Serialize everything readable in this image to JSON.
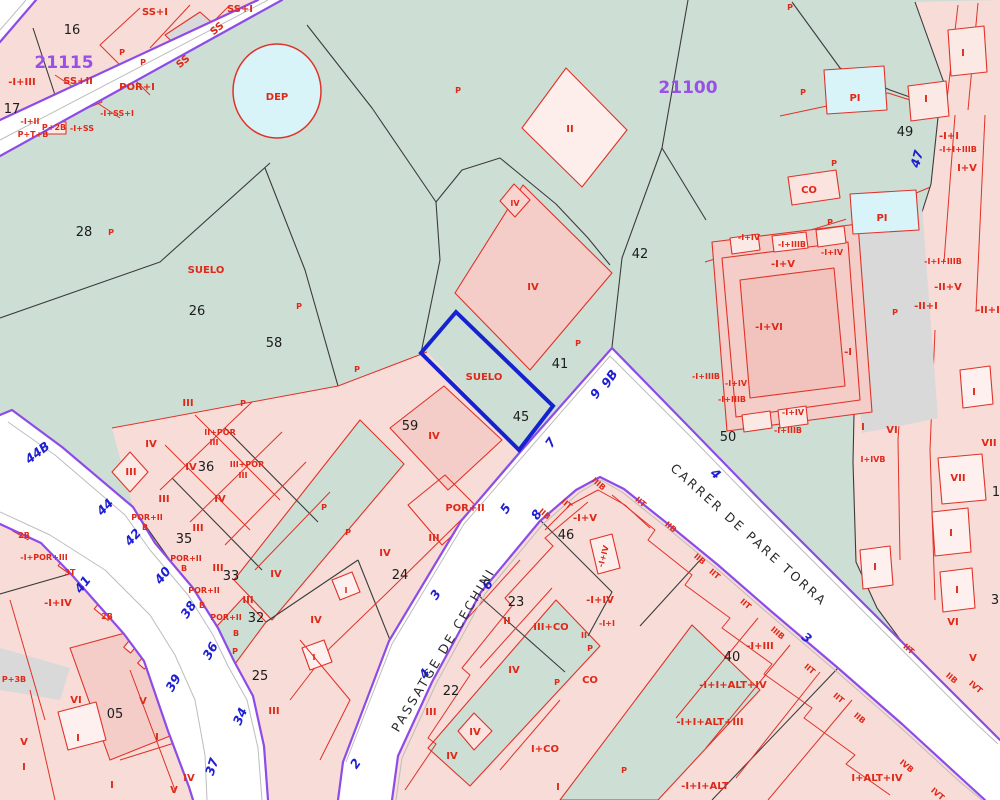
{
  "map": {
    "zone_ids": [
      "21115",
      "21100"
    ],
    "street_names": [
      "PASSATGE DE CECHINI",
      "CARRER DE PARE TORRA"
    ],
    "highlighted_parcel": {
      "number": "45",
      "land_label": "SUELO"
    },
    "colors": {
      "land_green": "#cddfd5",
      "parcel_pink": "#f8dcd7",
      "building_pink": "#f5cdc8",
      "road_white": "#ffffff",
      "boundary_purple": "#8d4be8",
      "highlight_blue": "#1523cf",
      "cadastre_red": "#e02818",
      "zone_purple": "#9950e8",
      "water_cyan": "#d8f4f8"
    }
  },
  "labels": [
    {
      "t": "16",
      "x": 72,
      "y": 34,
      "c": "k"
    },
    {
      "t": "21115",
      "x": 64,
      "y": 68,
      "c": "v",
      "n": "zone-id-21115"
    },
    {
      "t": "-I+III",
      "x": 22,
      "y": 85,
      "c": "r"
    },
    {
      "t": "SS+II",
      "x": 78,
      "y": 84,
      "c": "r"
    },
    {
      "t": "17",
      "x": 12,
      "y": 113,
      "c": "k"
    },
    {
      "t": "POR+I",
      "x": 137,
      "y": 90,
      "c": "r"
    },
    {
      "t": "-I+SS+I",
      "x": 117,
      "y": 116,
      "c": "s"
    },
    {
      "t": "-I+II",
      "x": 30,
      "y": 124,
      "c": "s"
    },
    {
      "t": "P+2B",
      "x": 54,
      "y": 130,
      "c": "s"
    },
    {
      "t": "P+T+B",
      "x": 33,
      "y": 137,
      "c": "s"
    },
    {
      "t": "-I+SS",
      "x": 82,
      "y": 131,
      "c": "s"
    },
    {
      "t": "SS+I",
      "x": 155,
      "y": 15,
      "c": "r"
    },
    {
      "t": "SS+I",
      "x": 240,
      "y": 12,
      "c": "r"
    },
    {
      "t": "SS",
      "x": 219,
      "y": 31,
      "c": "r",
      "r": -40
    },
    {
      "t": "SS",
      "x": 185,
      "y": 64,
      "c": "r",
      "r": -40
    },
    {
      "t": "P",
      "x": 122,
      "y": 55,
      "c": "s"
    },
    {
      "t": "P",
      "x": 143,
      "y": 65,
      "c": "s"
    },
    {
      "t": "DEP",
      "x": 277,
      "y": 100,
      "c": "r",
      "n": "deposit-label"
    },
    {
      "t": "P",
      "x": 458,
      "y": 93,
      "c": "s"
    },
    {
      "t": "28",
      "x": 84,
      "y": 236,
      "c": "k"
    },
    {
      "t": "P",
      "x": 111,
      "y": 235,
      "c": "s"
    },
    {
      "t": "SUELO",
      "x": 206,
      "y": 273,
      "c": "r"
    },
    {
      "t": "26",
      "x": 197,
      "y": 315,
      "c": "k"
    },
    {
      "t": "58",
      "x": 274,
      "y": 347,
      "c": "k"
    },
    {
      "t": "P",
      "x": 299,
      "y": 309,
      "c": "s"
    },
    {
      "t": "P",
      "x": 357,
      "y": 372,
      "c": "s"
    },
    {
      "t": "II",
      "x": 570,
      "y": 132,
      "c": "r"
    },
    {
      "t": "21100",
      "x": 688,
      "y": 93,
      "c": "v",
      "n": "zone-id-21100"
    },
    {
      "t": "42",
      "x": 640,
      "y": 258,
      "c": "k"
    },
    {
      "t": "P",
      "x": 578,
      "y": 346,
      "c": "s"
    },
    {
      "t": "41",
      "x": 560,
      "y": 368,
      "c": "k"
    },
    {
      "t": "IV",
      "x": 533,
      "y": 290,
      "c": "r"
    },
    {
      "t": "IV",
      "x": 515,
      "y": 206,
      "c": "s"
    },
    {
      "t": "SUELO",
      "x": 484,
      "y": 380,
      "c": "r",
      "n": "highlight-suelo-label"
    },
    {
      "t": "45",
      "x": 521,
      "y": 421,
      "c": "k",
      "n": "highlight-parcel-number"
    },
    {
      "t": "50",
      "x": 728,
      "y": 441,
      "c": "k"
    },
    {
      "t": "49",
      "x": 905,
      "y": 136,
      "c": "k"
    },
    {
      "t": "47",
      "x": 921,
      "y": 160,
      "c": "b",
      "r": -75
    },
    {
      "t": "P",
      "x": 803,
      "y": 95,
      "c": "s"
    },
    {
      "t": "P",
      "x": 790,
      "y": 10,
      "c": "s"
    },
    {
      "t": "PI",
      "x": 855,
      "y": 101,
      "c": "r"
    },
    {
      "t": "P",
      "x": 834,
      "y": 166,
      "c": "s"
    },
    {
      "t": "CO",
      "x": 809,
      "y": 193,
      "c": "r"
    },
    {
      "t": "PI",
      "x": 882,
      "y": 221,
      "c": "r"
    },
    {
      "t": "P",
      "x": 830,
      "y": 225,
      "c": "s"
    },
    {
      "t": "P",
      "x": 895,
      "y": 315,
      "c": "s"
    },
    {
      "t": "I",
      "x": 963,
      "y": 56,
      "c": "r"
    },
    {
      "t": "I",
      "x": 926,
      "y": 102,
      "c": "r"
    },
    {
      "t": "-I+I",
      "x": 949,
      "y": 139,
      "c": "r"
    },
    {
      "t": "-I+I+IIIB",
      "x": 958,
      "y": 152,
      "c": "s"
    },
    {
      "t": "I+V",
      "x": 967,
      "y": 171,
      "c": "r"
    },
    {
      "t": "-I+I+IIIB",
      "x": 943,
      "y": 264,
      "c": "s"
    },
    {
      "t": "-II+V",
      "x": 948,
      "y": 290,
      "c": "r"
    },
    {
      "t": "-II+I",
      "x": 926,
      "y": 309,
      "c": "r"
    },
    {
      "t": "-II+I",
      "x": 988,
      "y": 313,
      "c": "r"
    },
    {
      "t": "I",
      "x": 974,
      "y": 395,
      "c": "r"
    },
    {
      "t": "I",
      "x": 863,
      "y": 430,
      "c": "r"
    },
    {
      "t": "VI",
      "x": 892,
      "y": 433,
      "c": "r"
    },
    {
      "t": "I+IVB",
      "x": 873,
      "y": 462,
      "c": "s"
    },
    {
      "t": "VII",
      "x": 989,
      "y": 446,
      "c": "r"
    },
    {
      "t": "VII",
      "x": 958,
      "y": 481,
      "c": "r"
    },
    {
      "t": "1",
      "x": 996,
      "y": 496,
      "c": "k"
    },
    {
      "t": "I",
      "x": 951,
      "y": 536,
      "c": "r"
    },
    {
      "t": "I",
      "x": 875,
      "y": 570,
      "c": "r"
    },
    {
      "t": "I",
      "x": 957,
      "y": 593,
      "c": "r"
    },
    {
      "t": "3",
      "x": 995,
      "y": 604,
      "c": "k"
    },
    {
      "t": "VI",
      "x": 953,
      "y": 625,
      "c": "r"
    },
    {
      "t": "V",
      "x": 973,
      "y": 661,
      "c": "r"
    },
    {
      "t": "-I+IV",
      "x": 749,
      "y": 240,
      "c": "s"
    },
    {
      "t": "-I+IIIB",
      "x": 792,
      "y": 247,
      "c": "s"
    },
    {
      "t": "-I+IV",
      "x": 832,
      "y": 255,
      "c": "s"
    },
    {
      "t": "-I+V",
      "x": 783,
      "y": 267,
      "c": "r"
    },
    {
      "t": "-I+VI",
      "x": 769,
      "y": 330,
      "c": "r"
    },
    {
      "t": "-I",
      "x": 848,
      "y": 355,
      "c": "r"
    },
    {
      "t": "-I+IIIB",
      "x": 706,
      "y": 379,
      "c": "s"
    },
    {
      "t": "-I+IV",
      "x": 736,
      "y": 386,
      "c": "s"
    },
    {
      "t": "-I+IIIB",
      "x": 732,
      "y": 402,
      "c": "s"
    },
    {
      "t": "-I+IV",
      "x": 793,
      "y": 415,
      "c": "s"
    },
    {
      "t": "-I+IIIB",
      "x": 788,
      "y": 433,
      "c": "s"
    },
    {
      "t": "9B",
      "x": 613,
      "y": 381,
      "c": "b",
      "r": -55
    },
    {
      "t": "9",
      "x": 599,
      "y": 396,
      "c": "b",
      "r": -55
    },
    {
      "t": "7",
      "x": 554,
      "y": 445,
      "c": "b",
      "r": -55
    },
    {
      "t": "5",
      "x": 509,
      "y": 511,
      "c": "b",
      "r": -55
    },
    {
      "t": "8",
      "x": 540,
      "y": 517,
      "c": "b",
      "r": -55
    },
    {
      "t": "6",
      "x": 491,
      "y": 587,
      "c": "b",
      "r": -55
    },
    {
      "t": "3",
      "x": 439,
      "y": 597,
      "c": "b",
      "r": -55
    },
    {
      "t": "4",
      "x": 428,
      "y": 676,
      "c": "b",
      "r": -55
    },
    {
      "t": "2",
      "x": 359,
      "y": 766,
      "c": "b",
      "r": -55
    },
    {
      "t": "4",
      "x": 713,
      "y": 477,
      "c": "b",
      "r": 40
    },
    {
      "t": "3",
      "x": 804,
      "y": 641,
      "c": "b",
      "r": 40
    },
    {
      "t": "44B",
      "x": 40,
      "y": 456,
      "c": "b",
      "r": -38
    },
    {
      "t": "44",
      "x": 108,
      "y": 510,
      "c": "b",
      "r": -45
    },
    {
      "t": "42",
      "x": 136,
      "y": 540,
      "c": "b",
      "r": -48
    },
    {
      "t": "40",
      "x": 166,
      "y": 578,
      "c": "b",
      "r": -52
    },
    {
      "t": "41",
      "x": 86,
      "y": 587,
      "c": "b",
      "r": -52
    },
    {
      "t": "38",
      "x": 192,
      "y": 612,
      "c": "b",
      "r": -56
    },
    {
      "t": "36",
      "x": 214,
      "y": 653,
      "c": "b",
      "r": -60
    },
    {
      "t": "39",
      "x": 177,
      "y": 685,
      "c": "b",
      "r": -60
    },
    {
      "t": "34",
      "x": 244,
      "y": 718,
      "c": "b",
      "r": -66
    },
    {
      "t": "37",
      "x": 216,
      "y": 768,
      "c": "b",
      "r": -72
    },
    {
      "t": "PASSATGE DE CECHINI",
      "x": 447,
      "y": 652,
      "c": "st",
      "r": -59,
      "n": "street-name-passatge-de-cechini"
    },
    {
      "t": "CARRER DE PARE TORRA",
      "x": 746,
      "y": 538,
      "c": "st",
      "r": 42,
      "n": "street-name-carrer-de-pare-torra"
    },
    {
      "t": "III",
      "x": 188,
      "y": 406,
      "c": "r"
    },
    {
      "t": "P",
      "x": 243,
      "y": 406,
      "c": "s"
    },
    {
      "t": "II+POR",
      "x": 220,
      "y": 435,
      "c": "s"
    },
    {
      "t": "III",
      "x": 214,
      "y": 445,
      "c": "s"
    },
    {
      "t": "III+POR",
      "x": 247,
      "y": 467,
      "c": "s"
    },
    {
      "t": "III",
      "x": 243,
      "y": 478,
      "c": "s"
    },
    {
      "t": "IV",
      "x": 151,
      "y": 447,
      "c": "r"
    },
    {
      "t": "III",
      "x": 131,
      "y": 475,
      "c": "r"
    },
    {
      "t": "IV",
      "x": 191,
      "y": 470,
      "c": "r"
    },
    {
      "t": "36",
      "x": 206,
      "y": 471,
      "c": "k"
    },
    {
      "t": "III",
      "x": 164,
      "y": 502,
      "c": "r"
    },
    {
      "t": "IV",
      "x": 220,
      "y": 502,
      "c": "r"
    },
    {
      "t": "III",
      "x": 198,
      "y": 531,
      "c": "r"
    },
    {
      "t": "35",
      "x": 184,
      "y": 543,
      "c": "k"
    },
    {
      "t": "POR+II",
      "x": 147,
      "y": 520,
      "c": "s"
    },
    {
      "t": "B",
      "x": 145,
      "y": 530,
      "c": "s"
    },
    {
      "t": "III",
      "x": 218,
      "y": 571,
      "c": "r"
    },
    {
      "t": "33",
      "x": 231,
      "y": 580,
      "c": "k"
    },
    {
      "t": "POR+II",
      "x": 186,
      "y": 561,
      "c": "s"
    },
    {
      "t": "B",
      "x": 184,
      "y": 571,
      "c": "s"
    },
    {
      "t": "POR+II",
      "x": 204,
      "y": 593,
      "c": "s"
    },
    {
      "t": "B",
      "x": 202,
      "y": 608,
      "c": "s"
    },
    {
      "t": "POR+II",
      "x": 226,
      "y": 620,
      "c": "s"
    },
    {
      "t": "32",
      "x": 256,
      "y": 622,
      "c": "k"
    },
    {
      "t": "B",
      "x": 236,
      "y": 636,
      "c": "s"
    },
    {
      "t": "P",
      "x": 235,
      "y": 654,
      "c": "s"
    },
    {
      "t": "IV",
      "x": 276,
      "y": 577,
      "c": "r"
    },
    {
      "t": "III",
      "x": 248,
      "y": 603,
      "c": "r"
    },
    {
      "t": "59",
      "x": 410,
      "y": 430,
      "c": "k"
    },
    {
      "t": "IV",
      "x": 434,
      "y": 439,
      "c": "r"
    },
    {
      "t": "POR+II",
      "x": 465,
      "y": 511,
      "c": "r"
    },
    {
      "t": "III",
      "x": 434,
      "y": 541,
      "c": "r"
    },
    {
      "t": "IV",
      "x": 385,
      "y": 556,
      "c": "r"
    },
    {
      "t": "24",
      "x": 400,
      "y": 579,
      "c": "k"
    },
    {
      "t": "I",
      "x": 346,
      "y": 593,
      "c": "s"
    },
    {
      "t": "IV",
      "x": 316,
      "y": 623,
      "c": "r"
    },
    {
      "t": "25",
      "x": 260,
      "y": 680,
      "c": "k"
    },
    {
      "t": "I",
      "x": 314,
      "y": 660,
      "c": "s"
    },
    {
      "t": "III",
      "x": 274,
      "y": 714,
      "c": "r"
    },
    {
      "t": "P",
      "x": 324,
      "y": 510,
      "c": "s"
    },
    {
      "t": "P",
      "x": 348,
      "y": 535,
      "c": "s"
    },
    {
      "t": "-I+POR+III",
      "x": 44,
      "y": 560,
      "c": "s"
    },
    {
      "t": "2B",
      "x": 24,
      "y": 538,
      "c": "s"
    },
    {
      "t": "3T",
      "x": 70,
      "y": 575,
      "c": "s"
    },
    {
      "t": "-I+IV",
      "x": 58,
      "y": 606,
      "c": "r"
    },
    {
      "t": "2B",
      "x": 107,
      "y": 619,
      "c": "s"
    },
    {
      "t": "P+3B",
      "x": 14,
      "y": 682,
      "c": "s"
    },
    {
      "t": "VI",
      "x": 76,
      "y": 703,
      "c": "r"
    },
    {
      "t": "05",
      "x": 115,
      "y": 718,
      "c": "k"
    },
    {
      "t": "I",
      "x": 78,
      "y": 741,
      "c": "r"
    },
    {
      "t": "V",
      "x": 143,
      "y": 704,
      "c": "r"
    },
    {
      "t": "I",
      "x": 157,
      "y": 740,
      "c": "r"
    },
    {
      "t": "V",
      "x": 24,
      "y": 745,
      "c": "r"
    },
    {
      "t": "I",
      "x": 24,
      "y": 770,
      "c": "r"
    },
    {
      "t": "IV",
      "x": 189,
      "y": 781,
      "c": "r"
    },
    {
      "t": "V",
      "x": 174,
      "y": 793,
      "c": "r"
    },
    {
      "t": "I",
      "x": 112,
      "y": 788,
      "c": "r"
    },
    {
      "t": "23",
      "x": 516,
      "y": 606,
      "c": "k"
    },
    {
      "t": "II",
      "x": 507,
      "y": 624,
      "c": "r"
    },
    {
      "t": "III+CO",
      "x": 551,
      "y": 630,
      "c": "r"
    },
    {
      "t": "IV",
      "x": 514,
      "y": 673,
      "c": "r"
    },
    {
      "t": "22",
      "x": 451,
      "y": 695,
      "c": "k"
    },
    {
      "t": "III",
      "x": 431,
      "y": 715,
      "c": "r"
    },
    {
      "t": "IV",
      "x": 475,
      "y": 735,
      "c": "r"
    },
    {
      "t": "IV",
      "x": 452,
      "y": 759,
      "c": "r"
    },
    {
      "t": "I+CO",
      "x": 545,
      "y": 752,
      "c": "r"
    },
    {
      "t": "I",
      "x": 558,
      "y": 790,
      "c": "r"
    },
    {
      "t": "CO",
      "x": 590,
      "y": 683,
      "c": "r"
    },
    {
      "t": "P",
      "x": 557,
      "y": 685,
      "c": "s"
    },
    {
      "t": "P",
      "x": 624,
      "y": 773,
      "c": "s"
    },
    {
      "t": "46",
      "x": 566,
      "y": 539,
      "c": "k"
    },
    {
      "t": "-I+V",
      "x": 585,
      "y": 521,
      "c": "r"
    },
    {
      "t": "-I+IV",
      "x": 606,
      "y": 557,
      "c": "s",
      "r": -75
    },
    {
      "t": "-I+IV",
      "x": 600,
      "y": 603,
      "c": "r"
    },
    {
      "t": "-I+I",
      "x": 607,
      "y": 626,
      "c": "s"
    },
    {
      "t": "II",
      "x": 584,
      "y": 638,
      "c": "s"
    },
    {
      "t": "P",
      "x": 590,
      "y": 651,
      "c": "s"
    },
    {
      "t": "40",
      "x": 732,
      "y": 661,
      "c": "k"
    },
    {
      "t": "-I+III",
      "x": 760,
      "y": 649,
      "c": "r"
    },
    {
      "t": "-I+I+ALT+IV",
      "x": 733,
      "y": 688,
      "c": "r"
    },
    {
      "t": "-I+I+ALT+III",
      "x": 710,
      "y": 725,
      "c": "r"
    },
    {
      "t": "-I+I+ALT",
      "x": 705,
      "y": 789,
      "c": "r"
    },
    {
      "t": "I+ALT+IV",
      "x": 877,
      "y": 781,
      "c": "r"
    },
    {
      "t": "IIIB",
      "x": 597,
      "y": 486,
      "c": "s",
      "r": 40
    },
    {
      "t": "IIT",
      "x": 565,
      "y": 506,
      "c": "s",
      "r": 40
    },
    {
      "t": "IIB",
      "x": 543,
      "y": 516,
      "c": "s",
      "r": 40
    },
    {
      "t": "IIT",
      "x": 639,
      "y": 504,
      "c": "s",
      "r": 40
    },
    {
      "t": "IIB",
      "x": 669,
      "y": 529,
      "c": "s",
      "r": 40
    },
    {
      "t": "IIB",
      "x": 698,
      "y": 561,
      "c": "s",
      "r": 40
    },
    {
      "t": "IIT",
      "x": 713,
      "y": 576,
      "c": "s",
      "r": 40
    },
    {
      "t": "IIT",
      "x": 744,
      "y": 606,
      "c": "s",
      "r": 40
    },
    {
      "t": "IIIB",
      "x": 776,
      "y": 635,
      "c": "s",
      "r": 40
    },
    {
      "t": "IIT",
      "x": 808,
      "y": 671,
      "c": "s",
      "r": 40
    },
    {
      "t": "IIT",
      "x": 837,
      "y": 700,
      "c": "s",
      "r": 40
    },
    {
      "t": "IIB",
      "x": 858,
      "y": 720,
      "c": "s",
      "r": 40
    },
    {
      "t": "IIT",
      "x": 907,
      "y": 651,
      "c": "s",
      "r": 40
    },
    {
      "t": "IIB",
      "x": 950,
      "y": 680,
      "c": "s",
      "r": 40
    },
    {
      "t": "IVT",
      "x": 974,
      "y": 689,
      "c": "s",
      "r": 40
    },
    {
      "t": "IVB",
      "x": 905,
      "y": 768,
      "c": "s",
      "r": 40
    },
    {
      "t": "IVT",
      "x": 936,
      "y": 796,
      "c": "s",
      "r": 40
    }
  ]
}
